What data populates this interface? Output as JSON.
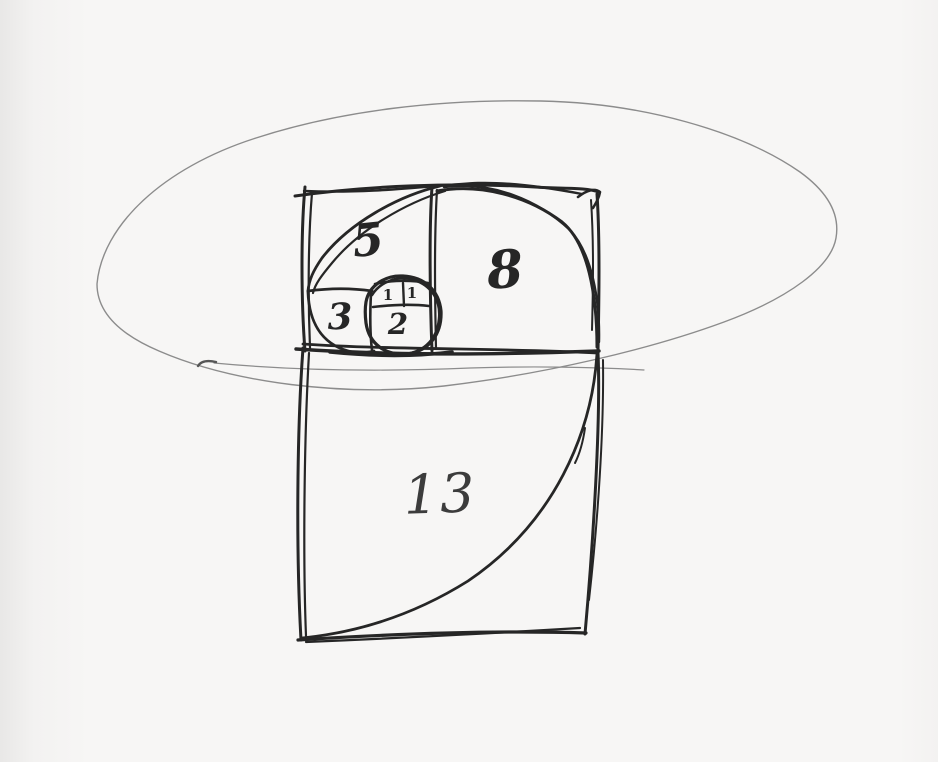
{
  "colors": {
    "paper": "#f7f6f5",
    "ink": "#262626",
    "ink_light": "#3c3c3c",
    "pencil": "#8c8c8c",
    "pencil_dark": "#565656"
  },
  "sketch": {
    "labels": {
      "square_13": "13",
      "square_8": "8",
      "square_5": "5",
      "square_3": "3",
      "square_2": "2",
      "square_1_left": "1",
      "square_1_right": "1"
    }
  }
}
